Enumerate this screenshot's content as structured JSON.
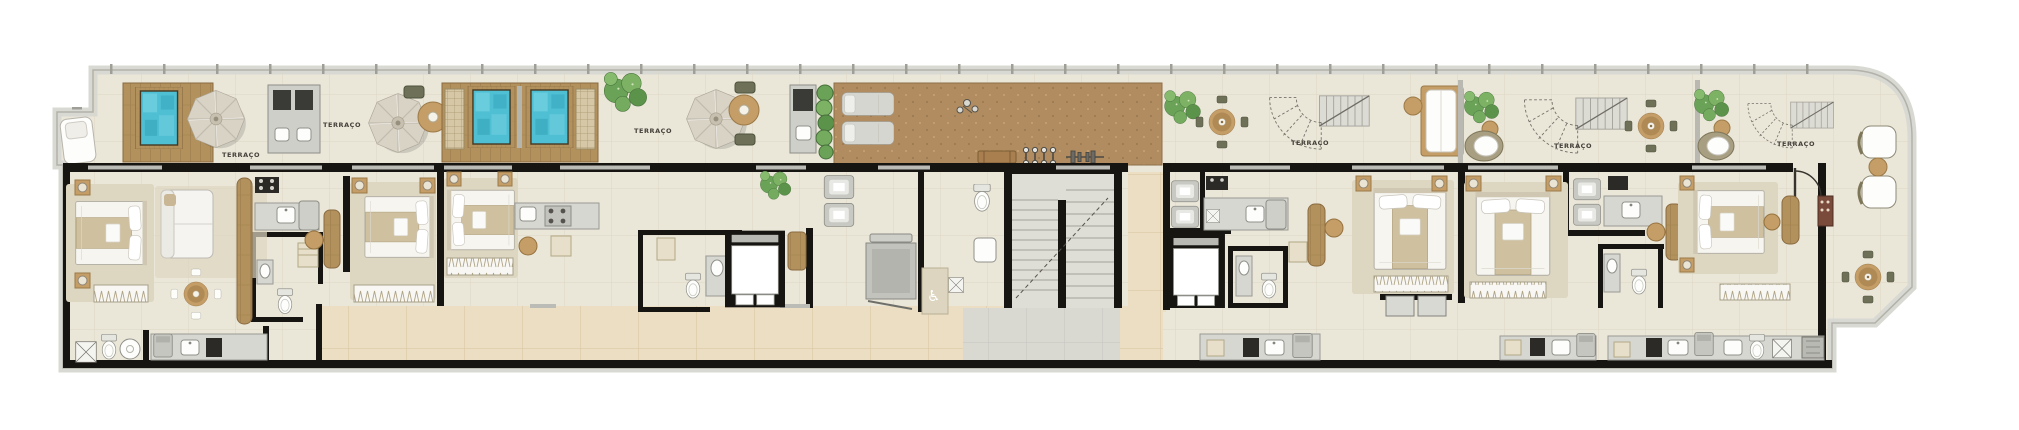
{
  "plan": {
    "type": "floor-plan",
    "language": "pt-BR",
    "room_labels": [
      {
        "text": "TERRAÇO",
        "x": 245,
        "y": 157
      },
      {
        "text": "TERRAÇO",
        "x": 346,
        "y": 127
      },
      {
        "text": "TERRAÇO",
        "x": 657,
        "y": 133
      },
      {
        "text": "TERRAÇO",
        "x": 1314,
        "y": 145
      },
      {
        "text": "TERRAÇO",
        "x": 1577,
        "y": 148
      },
      {
        "text": "TERRAÇO",
        "x": 1800,
        "y": 146
      }
    ],
    "icons": {
      "accessible_wc": "♿"
    },
    "colors": {
      "pool_water": "#4fbfd3",
      "pool_deep": "#2f9fb6",
      "wood_deck": "#b3915c",
      "deck_brown": "#b18c60",
      "terrace_tile": "#eae6d8",
      "tile_line": "#dcd6c4",
      "corridor_tile": "#ecdec3",
      "corridor_line": "#d9c49e",
      "wall": "#161511",
      "parapet": "#d9d9d3",
      "parapet_edge": "#b2b2aa",
      "furniture_wood": "#c49d67",
      "olive": "#6e7157",
      "plant_green": "#67a055",
      "landing": "#d9d8d1",
      "rug": "#ddd6c0",
      "label_text": "#45413a"
    }
  }
}
